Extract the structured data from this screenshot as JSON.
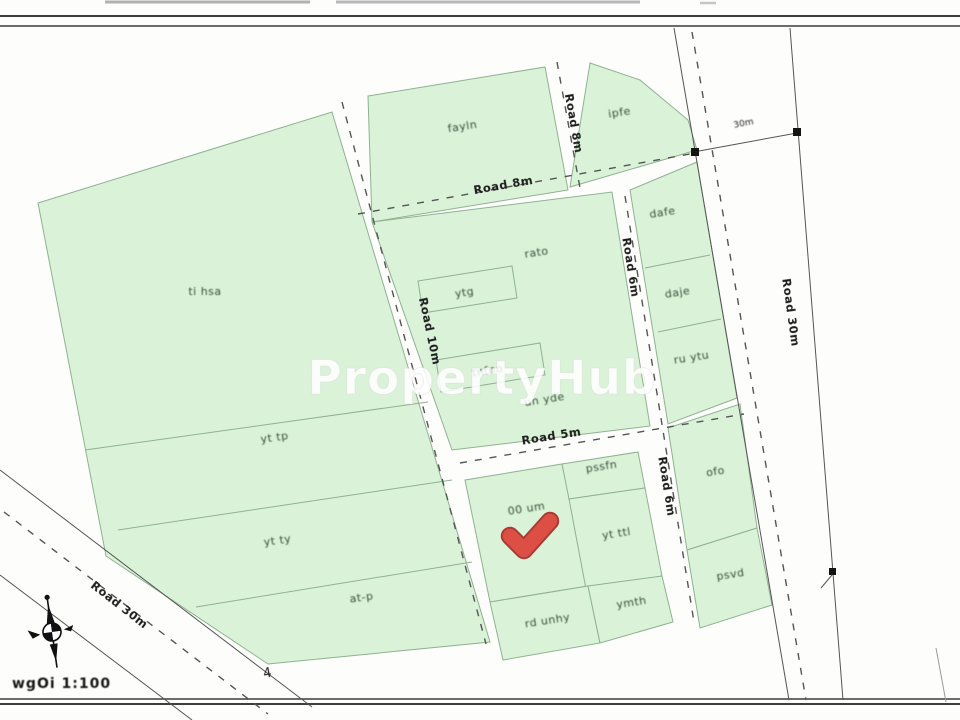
{
  "watermark": "PropertyHub",
  "scale_text": "wgOi 1:100",
  "annotation_4": "4",
  "dimension_30m": "30m",
  "roads": {
    "top_h": "Road 8m",
    "top_v": "Road 8m",
    "center_v": "Road 10m",
    "mid_h": "Road 5m",
    "right_v_upper": "Road 6m",
    "right_v_lower": "Road 6m",
    "wide_right": "Road 30m",
    "diag": "Road 30m"
  },
  "parcels": {
    "left_row1": "ti hsa",
    "left_row2": "yt tp",
    "left_row3": "yt ty",
    "left_row4": "at-p",
    "top_middle": "fayln",
    "wedge": "ipfe",
    "right_col_1": "dafe",
    "right_col_2": "daje",
    "right_col_3": "ru ytu",
    "mid_main_top": "rato",
    "mid_strip_a": "ytg",
    "mid_strip_b": "tnfno",
    "mid_main_bottom": "un yde",
    "plot_marked": "00 um",
    "lower_top_small": "pssfn",
    "lower_right_big": "yt ttl",
    "lower_bottom_left": "rd unhy",
    "lower_bottom_right": "ymth",
    "east_upper": "ofo",
    "east_lower": "psvd"
  },
  "colors": {
    "parcel_fill": "#daf2d8",
    "parcel_stroke": "#8fb290",
    "road_dash": "#555555",
    "marker_red": "#dd4f45",
    "watermark_white": "#ffffff"
  }
}
